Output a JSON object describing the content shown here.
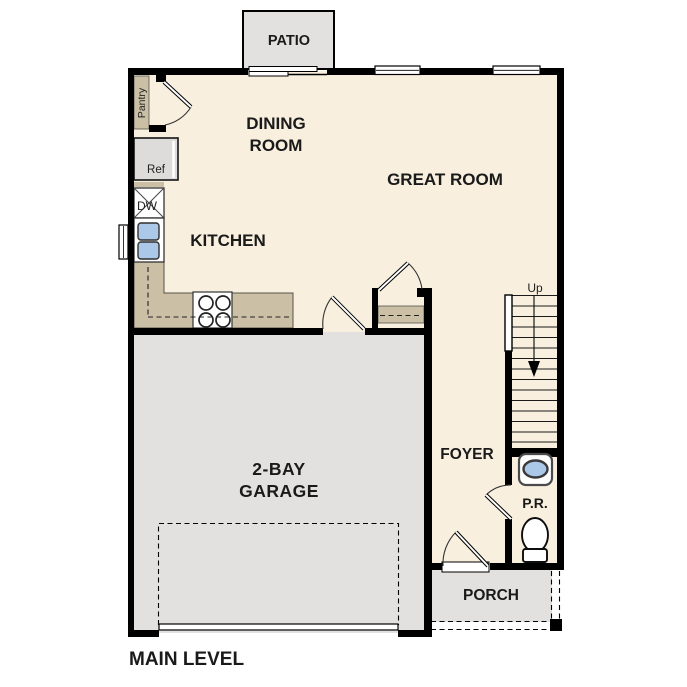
{
  "plan_title": "MAIN LEVEL",
  "rooms": {
    "patio": "PATIO",
    "dining_room": [
      "DINING",
      "ROOM"
    ],
    "great_room": "GREAT ROOM",
    "kitchen": "KITCHEN",
    "garage": [
      "2-BAY",
      "GARAGE"
    ],
    "foyer": "FOYER",
    "powder_room": "P.R.",
    "porch": "PORCH"
  },
  "labels": {
    "pantry": "Pantry",
    "refrigerator": "Ref",
    "dishwasher": "DW",
    "stairs_direction": "Up"
  },
  "colors": {
    "floor": "#f8efdf",
    "hardscape": "#e2e1df",
    "counter": "#cbc0a6",
    "appliance": "#dddcda",
    "fixture_blue": "#abc8e8",
    "wall": "#000000"
  }
}
